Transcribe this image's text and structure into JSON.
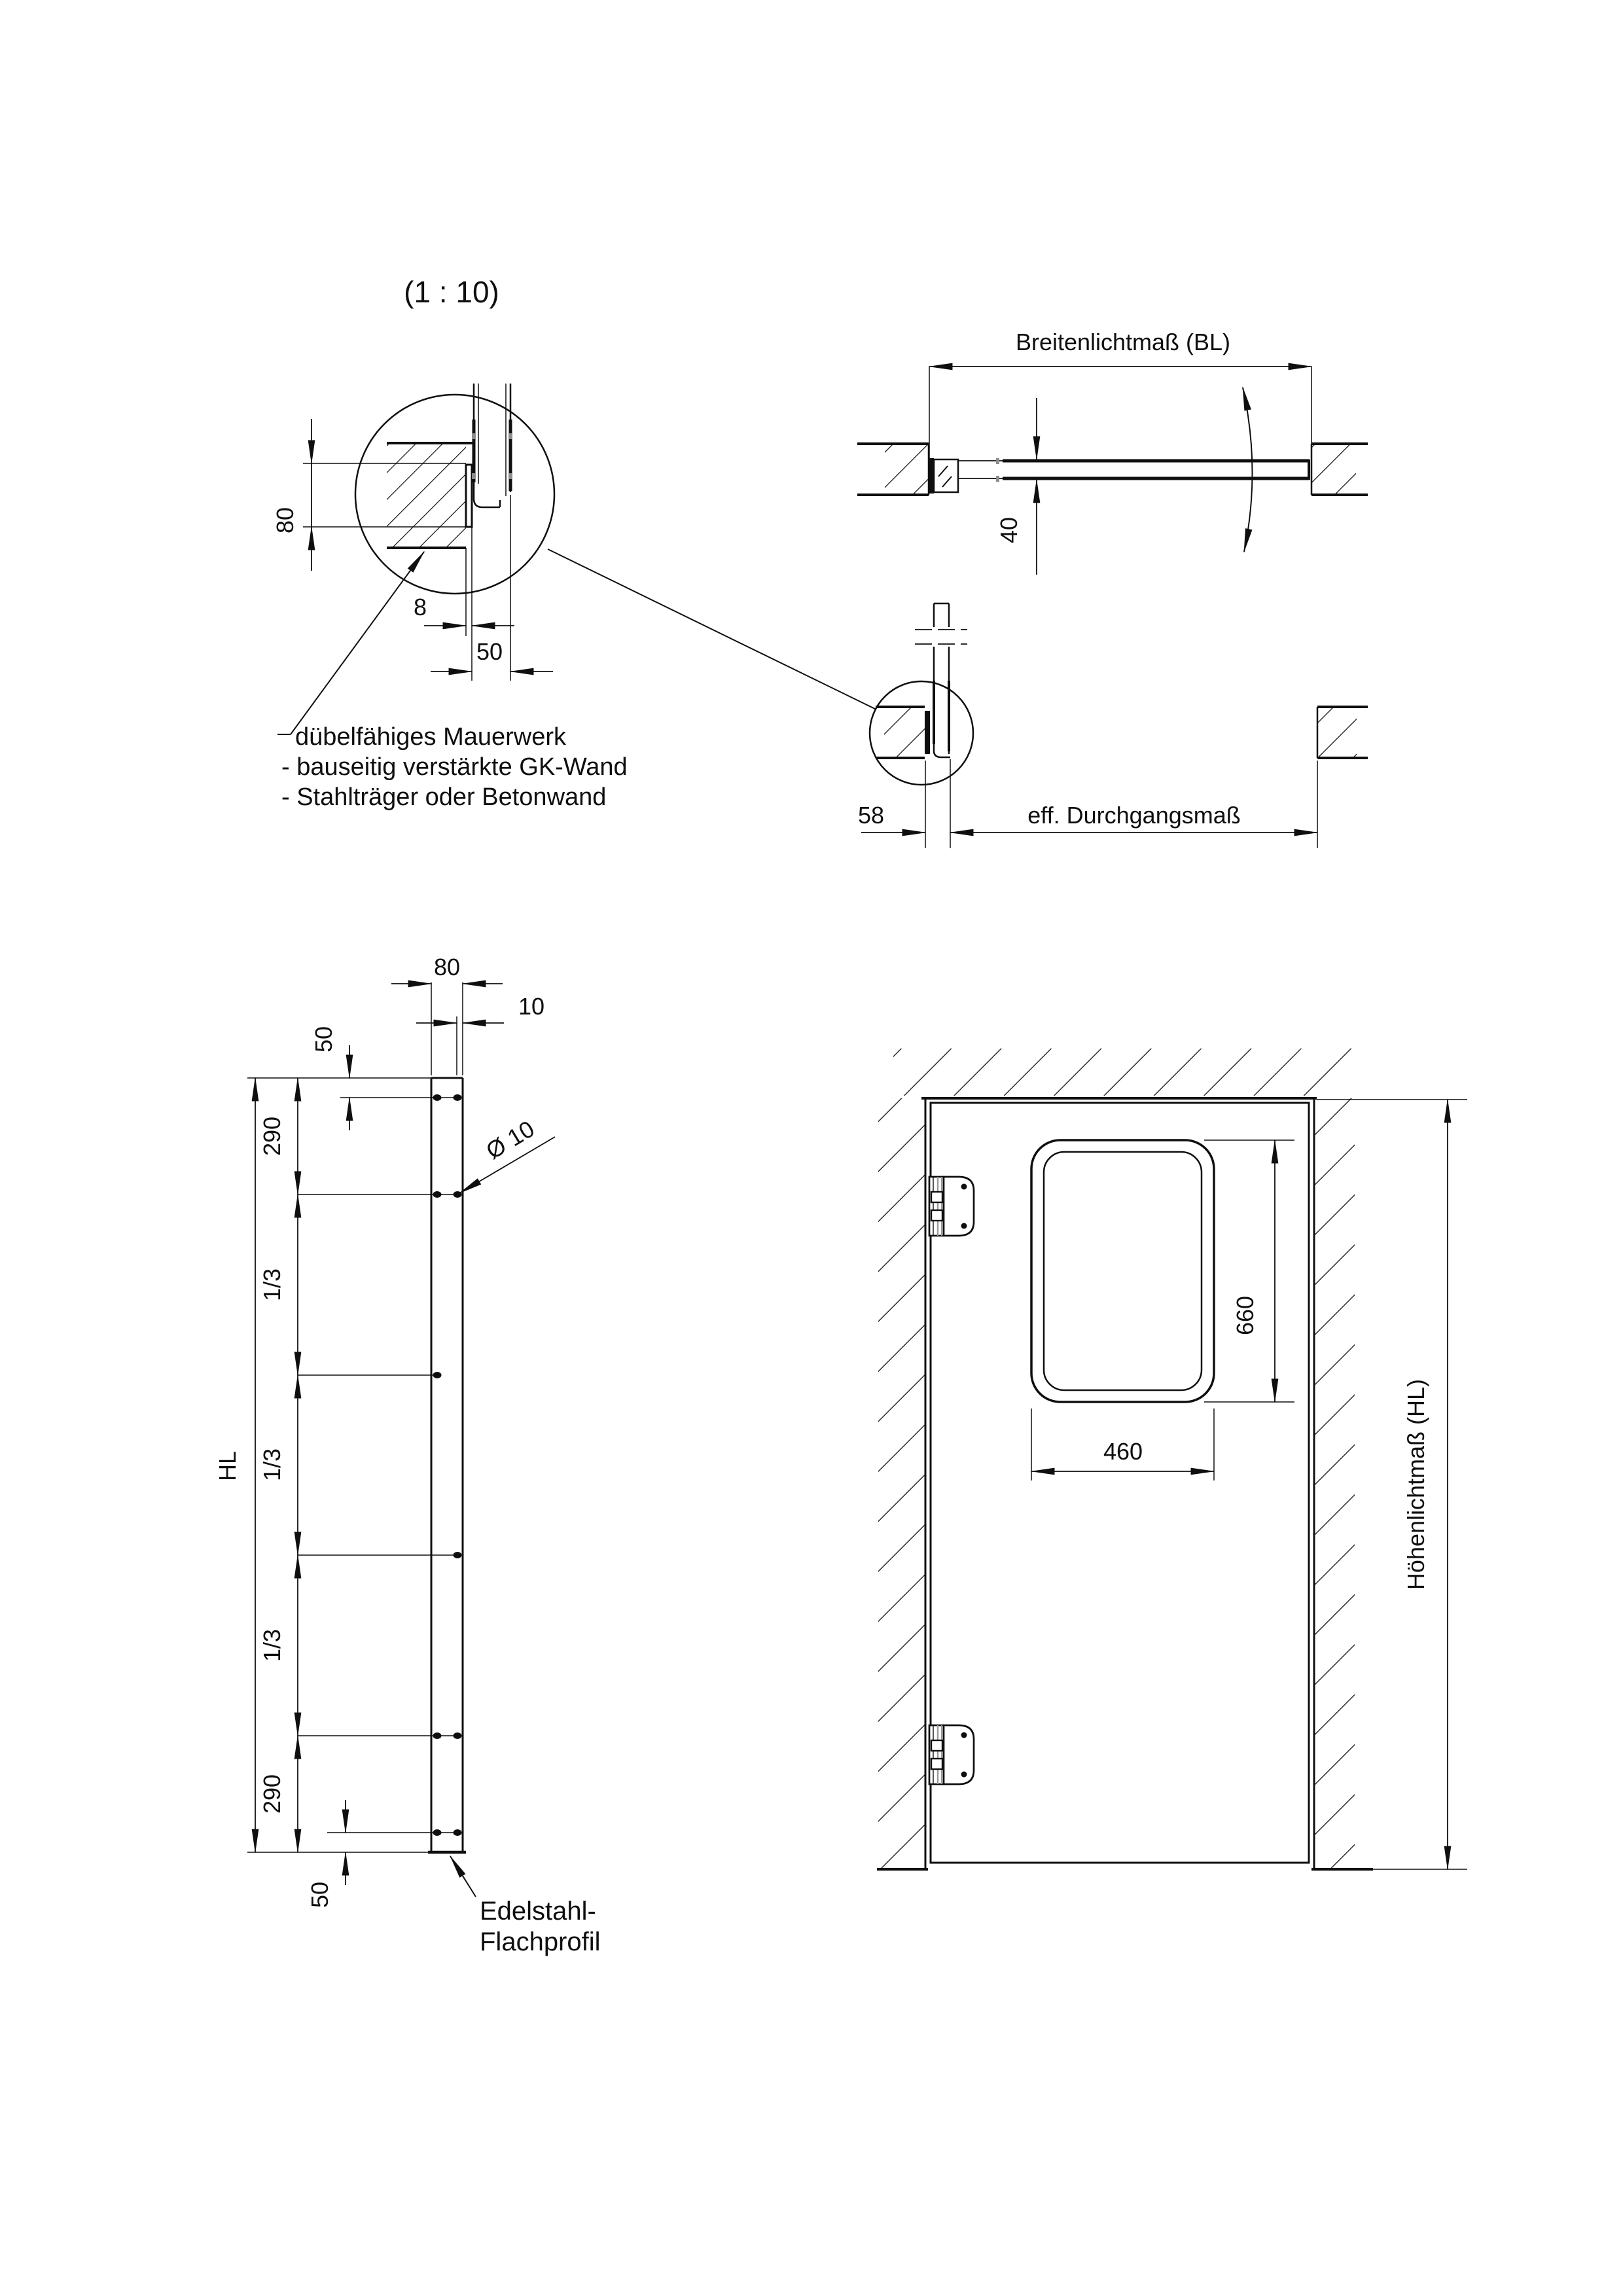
{
  "drawing": {
    "scale_label": "(1 : 10)",
    "detail": {
      "dim_height": "80",
      "dim_plate": "8",
      "dim_frame": "50",
      "note_line1": "dübelfähiges Mauerwerk",
      "note_line2": "- bauseitig verstärkte GK-Wand",
      "note_line3": "- Stahlträger oder Betonwand"
    },
    "plan": {
      "clear_width_label": "Breitenlichtmaß (BL)",
      "leaf_thickness": "40"
    },
    "section": {
      "hinge_offset": "58",
      "passage_label": "eff. Durchgangsmaß"
    },
    "profile": {
      "width": "80",
      "hole_offset": "10",
      "hole_top": "50",
      "seg_top": "290",
      "seg_third_1": "1/3",
      "seg_third_2": "1/3",
      "seg_third_3": "1/3",
      "seg_bottom": "290",
      "hole_bottom": "50",
      "height_label": "HL",
      "hole_dia": "Ø 10",
      "material1": "Edelstahl-",
      "material2": "Flachprofil"
    },
    "elevation": {
      "window_height": "660",
      "window_width": "460",
      "clear_height_label": "Höhenlichtmaß (HL)"
    }
  }
}
